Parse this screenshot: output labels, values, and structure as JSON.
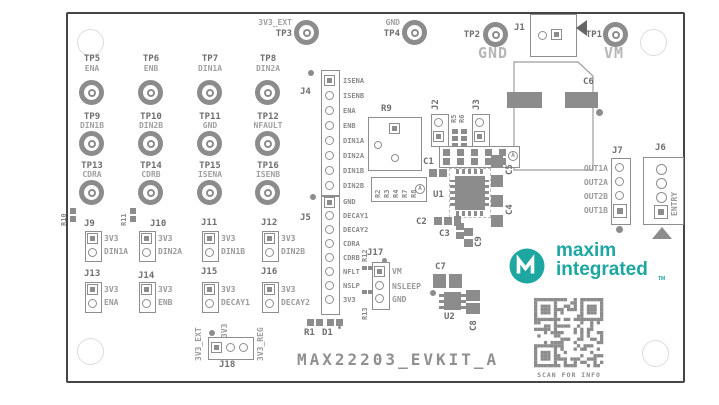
{
  "title": "MAX22203_EVKIT_A",
  "colors": {
    "teal": "#1ea7a1",
    "silk": "#8e8e8e",
    "pad": "#8c8c8c",
    "ref_text": "#6e6e6e",
    "signal_text": "#a0a0a0",
    "big_label": "#b6b6b6"
  },
  "branding": {
    "logo_line1": "maxim",
    "logo_line2": "integrated",
    "trademark": "TM",
    "qr_caption": "SCAN FOR INFO"
  },
  "power_labels": {
    "gnd": "GND",
    "vm": "VM"
  },
  "testpoints": {
    "top": [
      {
        "ref": "TP3",
        "signal": "3V3_EXT"
      },
      {
        "ref": "TP4",
        "signal": "GND"
      },
      {
        "ref": "TP2",
        "signal": ""
      },
      {
        "ref": "TP1",
        "signal": ""
      }
    ],
    "grid": [
      {
        "ref": "TP5",
        "signal": "ENA"
      },
      {
        "ref": "TP6",
        "signal": "ENB"
      },
      {
        "ref": "TP7",
        "signal": "DIN1A"
      },
      {
        "ref": "TP8",
        "signal": "DIN2A"
      },
      {
        "ref": "TP9",
        "signal": "DIN1B"
      },
      {
        "ref": "TP10",
        "signal": "DIN2B"
      },
      {
        "ref": "TP11",
        "signal": "GND"
      },
      {
        "ref": "TP12",
        "signal": "NFAULT"
      },
      {
        "ref": "TP13",
        "signal": "CDRA"
      },
      {
        "ref": "TP14",
        "signal": "CDRB"
      },
      {
        "ref": "TP15",
        "signal": "ISENA"
      },
      {
        "ref": "TP16",
        "signal": "ISENB"
      }
    ]
  },
  "headers": {
    "j1": {
      "ref": "J1"
    },
    "j2": {
      "ref": "J2"
    },
    "j3": {
      "ref": "J3"
    },
    "j4": {
      "ref": "J4",
      "pins": [
        "ISENA",
        "ISENB",
        "ENA",
        "ENB",
        "DIN1A",
        "DIN2A",
        "DIN1B",
        "DIN2B"
      ]
    },
    "j5": {
      "ref": "J5",
      "pins": [
        "GND",
        "DECAY1",
        "DECAY2",
        "CDRA",
        "CDRB",
        "NFLT",
        "NSLP",
        "3V3"
      ]
    },
    "j6": {
      "ref": "J6",
      "signal": "ENTRY"
    },
    "j7": {
      "ref": "J7",
      "pins": [
        "OUT1A",
        "OUT2A",
        "OUT2B",
        "OUT1B"
      ]
    },
    "j17": {
      "ref": "J17",
      "pins": [
        "VM",
        "NSLEEP",
        "GND"
      ]
    },
    "j18": {
      "ref": "J18",
      "pins": [
        "3V3_EXT",
        "3V3",
        "3V3_REG"
      ]
    }
  },
  "jumpers": [
    {
      "ref": "J9",
      "pin1": "3V3",
      "pin2": "DIN1A"
    },
    {
      "ref": "J10",
      "pin1": "3V3",
      "pin2": "DIN2A"
    },
    {
      "ref": "J11",
      "pin1": "3V3",
      "pin2": "DIN1B"
    },
    {
      "ref": "J12",
      "pin1": "3V3",
      "pin2": "DIN2B"
    },
    {
      "ref": "J13",
      "pin1": "3V3",
      "pin2": "ENA"
    },
    {
      "ref": "J14",
      "pin1": "3V3",
      "pin2": "ENB"
    },
    {
      "ref": "J15",
      "pin1": "3V3",
      "pin2": "DECAY1"
    },
    {
      "ref": "J16",
      "pin1": "3V3",
      "pin2": "DECAY2"
    }
  ],
  "components": {
    "u1": "U1",
    "u2": "U2",
    "r1": "R1",
    "d1": "D1",
    "r5": "R5",
    "r6": "R6",
    "r9": "R9",
    "r10": "R10",
    "r11": "R11",
    "r12": "R12",
    "r13": "R13",
    "r_array": [
      "R2",
      "R3",
      "R4",
      "R7",
      "R8"
    ],
    "c1": "C1",
    "c2": "C2",
    "c3": "C3",
    "c4": "C4",
    "c5": "C5",
    "c6": "C6",
    "c7": "C7",
    "c8": "C8",
    "c9": "C9",
    "variant_mark": "A"
  }
}
